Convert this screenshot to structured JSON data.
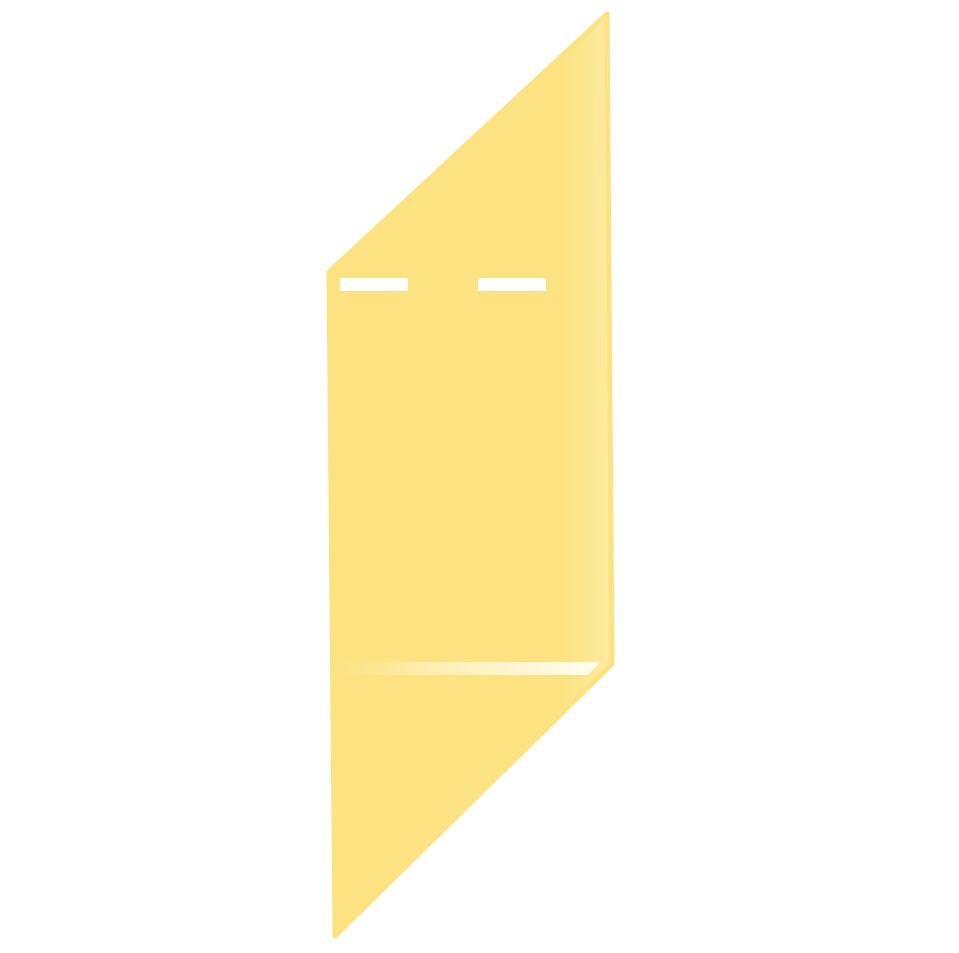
{
  "canvas": {
    "width": "959",
    "height": "953",
    "background_color": "#FFFFFF"
  },
  "note": {
    "name": "sheared-sticky-note",
    "fill_color": "#FCE281",
    "edge_highlight_color": "#FDE893",
    "edge_highlight_color_strong": "#FEEC9F",
    "outline_points": "329,272 607,14 612,664 335,936",
    "text_line_color": "#FFFFFF",
    "text_lines": [
      {
        "x": "340",
        "y": "278",
        "width": "68",
        "height": "13"
      },
      {
        "x": "478",
        "y": "278",
        "width": "68",
        "height": "13"
      }
    ],
    "divider": {
      "points": "337,662 600,662 588,675 337,675",
      "color_start": "rgba(255,252,235,0)",
      "color_mid": "rgba(255,252,238,0.55)",
      "color_end": "#FFFDF3"
    }
  }
}
